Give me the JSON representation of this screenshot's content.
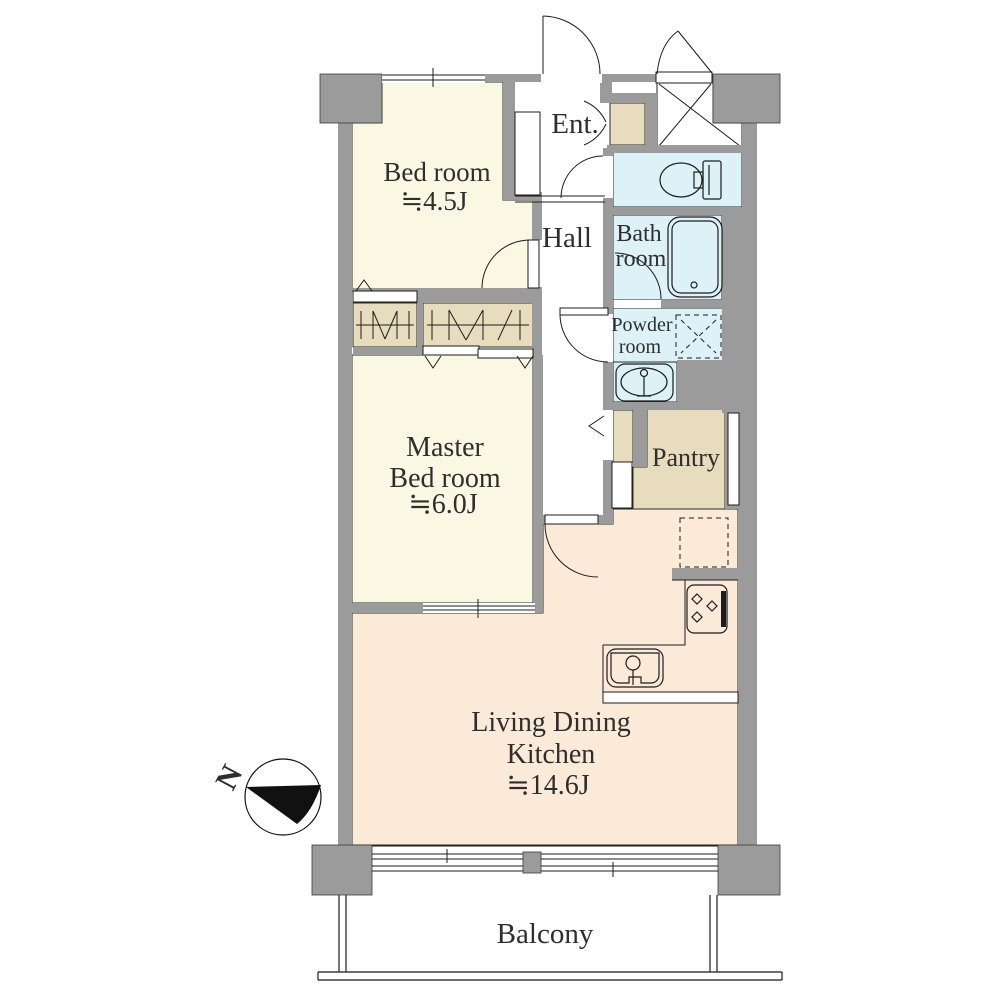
{
  "plan": {
    "compass_label": "N",
    "rooms": {
      "bedroom": {
        "line1": "Bed room",
        "size": "≒4.5J"
      },
      "master": {
        "line1": "Master",
        "line2": "Bed room",
        "size": "≒6.0J"
      },
      "ldk": {
        "line1": "Living Dining",
        "line2": "Kitchen",
        "size": "≒14.6J"
      },
      "hall": {
        "label": "Hall"
      },
      "entrance": {
        "label": "Ent."
      },
      "bath": {
        "line1": "Bath",
        "line2": "room"
      },
      "powder": {
        "line1": "Powder",
        "line2": "room"
      },
      "pantry": {
        "label": "Pantry"
      },
      "balcony": {
        "label": "Balcony"
      }
    },
    "icons": [
      "compass-icon",
      "toilet-icon",
      "bathtub-icon",
      "washbasin-icon",
      "washer-space-icon",
      "fridge-space-icon",
      "stove-icon",
      "kitchen-sink-icon",
      "closet-hanger-icon"
    ],
    "colors": {
      "wall_gray": "#9b9b9b",
      "bedroom_floor": "#faf8e3",
      "ldk_floor": "#fcead8",
      "wet_area_floor": "#ddf1f8",
      "storage_floor": "#e7dcbe",
      "outline": "#1c1c1c"
    }
  }
}
